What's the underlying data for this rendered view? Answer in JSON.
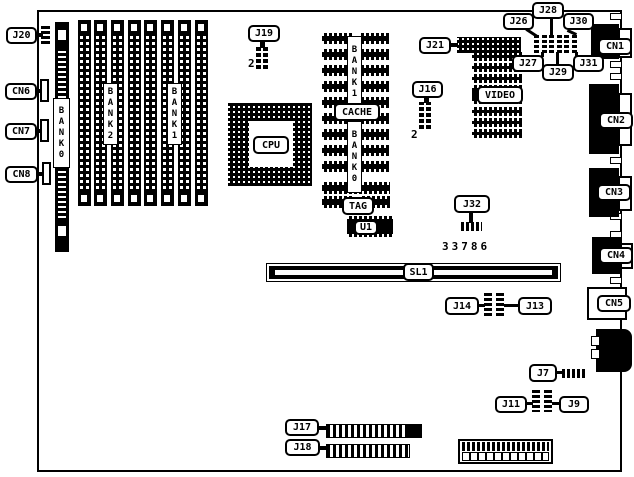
{
  "diagram": {
    "description": "Motherboard connector and jumper location diagram",
    "part_number": "33786",
    "colors": {
      "line": "#000000",
      "background": "#ffffff"
    }
  },
  "labels": {
    "j20": "J20",
    "cn6": "CN6",
    "cn7": "CN7",
    "cn8": "CN8",
    "bank0_simm_strip": "BANK0",
    "bank2": "BANK2",
    "bank1": "BANK1",
    "j19": "J19",
    "j19_pin": "2",
    "cpu": "CPU",
    "cache_bank1": "BANK1",
    "cache": "CACHE",
    "cache_bank0": "BANK0",
    "tag": "TAG",
    "u1": "U1",
    "j21": "J21",
    "j26": "J26",
    "j27": "J27",
    "j28": "J28",
    "j29": "J29",
    "j30": "J30",
    "j31": "J31",
    "cn1": "CN1",
    "cn2": "CN2",
    "cn3": "CN3",
    "cn4": "CN4",
    "cn5": "CN5",
    "video": "VIDEO",
    "j16": "J16",
    "j16_pin": "2",
    "j32": "J32",
    "sl1": "SL1",
    "j14": "J14",
    "j13": "J13",
    "j7": "J7",
    "j11": "J11",
    "j9": "J9",
    "j17": "J17",
    "j18": "J18"
  }
}
